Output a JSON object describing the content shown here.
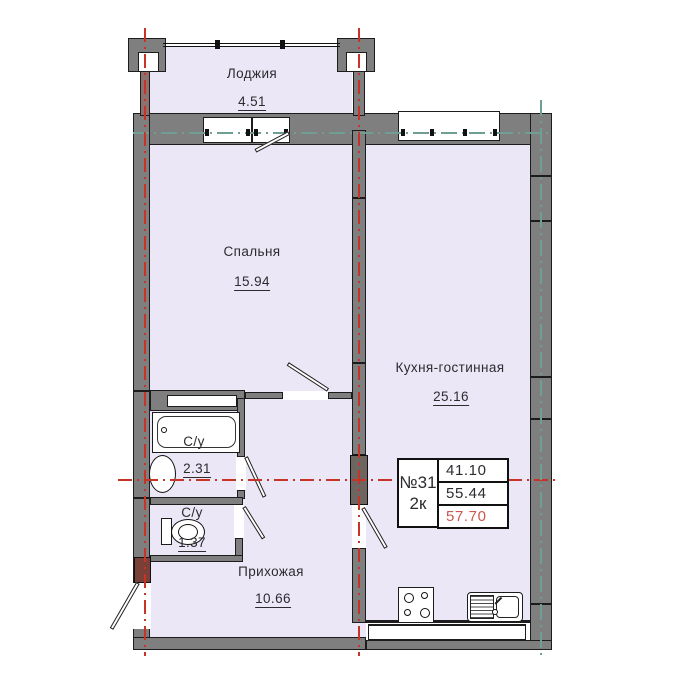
{
  "colors": {
    "room_fill": "#ECE7F6",
    "wall": "#7F7F7F",
    "wall_dark": "#6E6560",
    "outline": "#1C1C1C",
    "axis_red": "#C63428",
    "axis_teal": "#6F9E94",
    "entrance_block": "#7A4038",
    "loggia_wall": "#8F7070",
    "highlight_red": "#CB5850",
    "text": "#2B2B30"
  },
  "rooms": {
    "loggia": {
      "name": "Лоджия",
      "area": "4.51"
    },
    "bedroom": {
      "name": "Спальня",
      "area": "15.94"
    },
    "kitchen_living": {
      "name": "Кухня-гостинная",
      "area": "25.16"
    },
    "bathroom": {
      "name": "С/у",
      "area": "2.31"
    },
    "wc": {
      "name": "С/у",
      "area": "1.37"
    },
    "hallway": {
      "name": "Прихожая",
      "area": "10.66"
    }
  },
  "info_table": {
    "apartment_number": "№31",
    "rooms_count": "2к",
    "values": [
      "41.10",
      "55.44",
      "57.70"
    ]
  }
}
